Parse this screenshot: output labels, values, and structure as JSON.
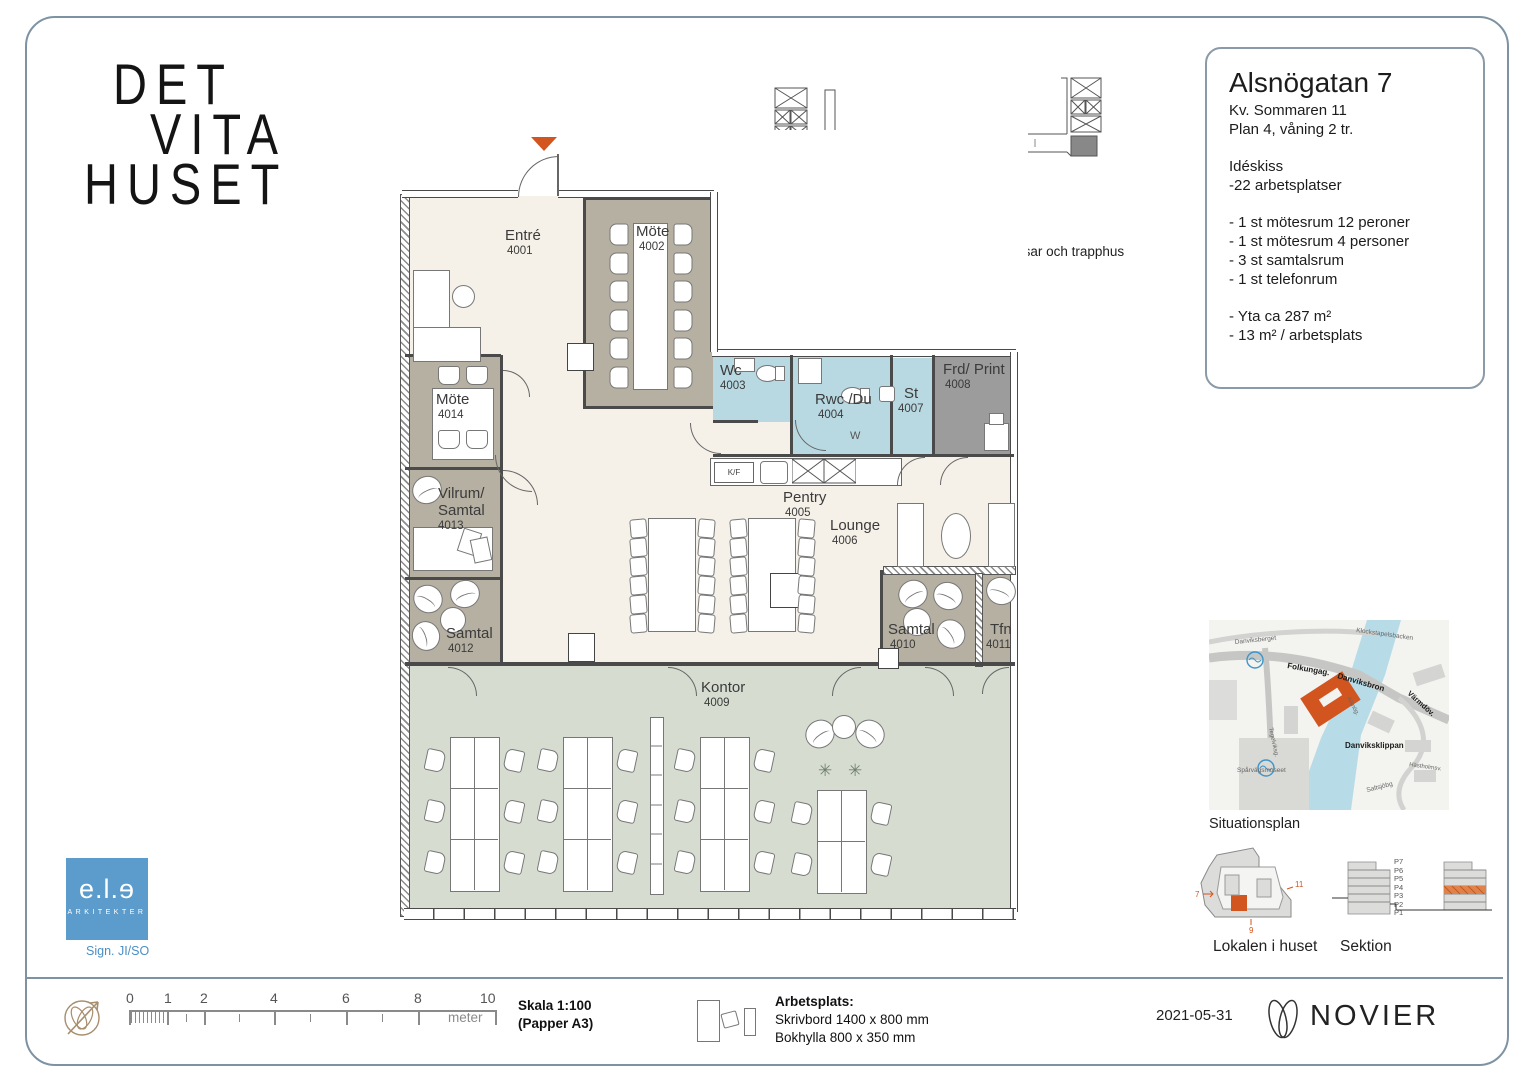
{
  "logo": {
    "line1": "DET",
    "line2": "VITA",
    "line3": "HUSET"
  },
  "info_box": {
    "title": "Alsnögatan 7",
    "sub1": "Kv. Sommaren 11",
    "sub2": "Plan 4, våning 2 tr.",
    "idea": "Idéskiss",
    "workplaces": "-22 arbetsplatser",
    "item1": "- 1 st mötesrum 12 peroner",
    "item2": "- 1 st mötesrum 4 personer",
    "item3": "- 3 st samtalsrum",
    "item4": "- 1 st telefonrum",
    "area1": "- Yta ca 287 m²",
    "area2": "- 13 m² / arbetsplats"
  },
  "overview_caption": "Lokalen i huset i förhållande till hissar och trapphus",
  "plan": {
    "rooms": {
      "entre": {
        "name": "Entré",
        "num": "4001"
      },
      "mote12": {
        "name": "Möte",
        "num": "4002"
      },
      "wc": {
        "name": "Wc",
        "num": "4003"
      },
      "rwc": {
        "name": "Rwc /Du",
        "num": "4004"
      },
      "pentry": {
        "name": "Pentry",
        "num": "4005"
      },
      "lounge": {
        "name": "Lounge",
        "num": "4006"
      },
      "st": {
        "name": "St",
        "num": "4007"
      },
      "frd": {
        "name": "Frd/ Print",
        "num": "4008"
      },
      "kontor": {
        "name": "Kontor",
        "num": "4009"
      },
      "samtal_a": {
        "name": "Samtal",
        "num": "4010"
      },
      "tfn": {
        "name": "Tfn",
        "num": "4011"
      },
      "samtal_b": {
        "name": "Samtal",
        "num": "4012"
      },
      "vilrum": {
        "name1": "Vilrum/",
        "name2": "Samtal",
        "num": "4013"
      },
      "mote4": {
        "name": "Möte",
        "num": "4014"
      }
    },
    "kitchen_label": "K/F"
  },
  "map": {
    "caption": "Situationsplan",
    "labels": {
      "klockstapelsbacken": "Klockstapelsbacken",
      "danviksberget": "Danviksberget",
      "folkungag": "Folkungag.",
      "danviksbron": "Danviksbron",
      "varmdov": "Värmdöv.",
      "alsnog": "Alsnög.",
      "danviksklippan": "Danviksklippan",
      "sparvagsmuseet": "Spårvägsmuseet",
      "tegelviksg": "Tegelviksg.",
      "hastholmsv": "Hästholmsv.",
      "saltsjobg": "Saltsjöbg"
    }
  },
  "locator": {
    "caption": "Lokalen i huset",
    "marker_left": "7",
    "marker_right": "11",
    "marker_bottom": "9"
  },
  "sektion": {
    "caption": "Sektion",
    "floors": [
      "P7",
      "P6",
      "P5",
      "P4",
      "P3",
      "P2",
      "P1"
    ]
  },
  "ele": {
    "brand": "e.l.ɘ",
    "sub": "ARKITEKTER",
    "sign": "Sign. JI/SO"
  },
  "footer": {
    "scale_ticks": [
      "0",
      "1",
      "2",
      "4",
      "6",
      "8",
      "10"
    ],
    "unit": "meter",
    "scale1": "Skala 1:100",
    "scale2": "(Papper A3)",
    "wp1": "Arbetsplats:",
    "wp2": "Skrivbord 1400 x 800 mm",
    "wp3": "Bokhylla 800 x 350 mm",
    "date": "2021-05-31",
    "brand": "NOVIER"
  },
  "colors": {
    "accent_orange": "#d2551f",
    "room_taupe": "#b6b0a2",
    "floor_cream": "#f5f1e8",
    "wet_blue": "#b9d9e2",
    "print_grey": "#9c9c9c",
    "office_green": "#d6ddd0",
    "logo_blue": "#5b9ccc",
    "frame_blue": "#7d93a3"
  }
}
